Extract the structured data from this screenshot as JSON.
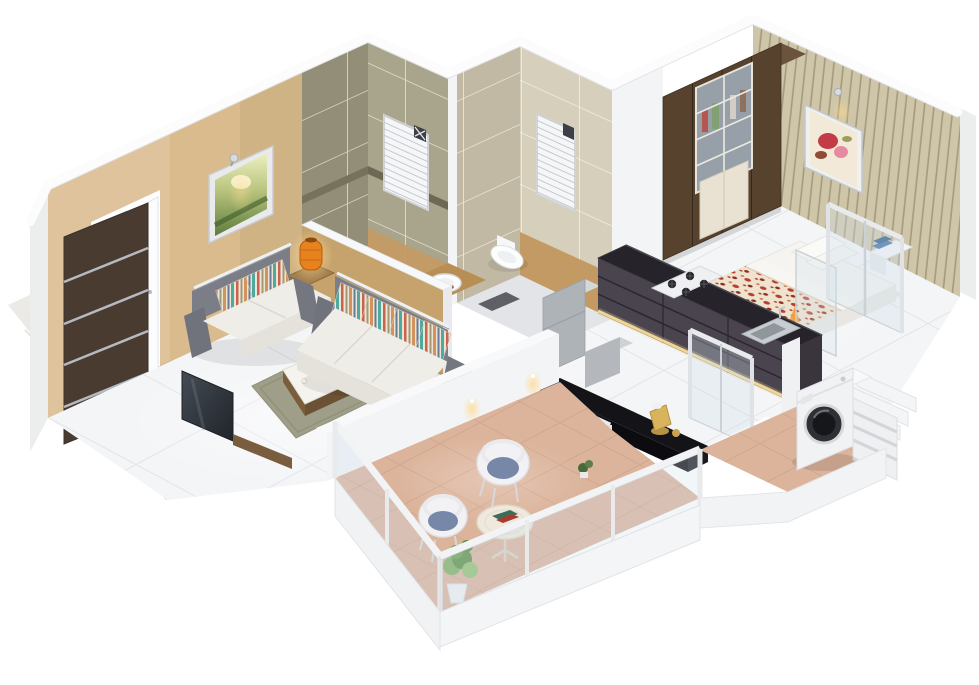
{
  "meta": {
    "aria_label": "3D isometric cutaway render of a 1 BHK apartment floor plan, dollhouse view from above, no text labels",
    "render_style": "isometric-cutaway-dollhouse",
    "visible_text": ""
  },
  "colors": {
    "background": "#ffffff",
    "floor_tile": "#f4f5f7",
    "wall_white": "#f3f4f6",
    "wall_side": "#eceded",
    "ceiling": "#fcfcfd",
    "wall_tan": "#d9bb8e",
    "half_wall_tan": "#c6a36d",
    "tile_olive": "#a9a58c",
    "tile_olive_dark": "#928e77",
    "tile_cream": "#d6cfbb",
    "tile_cream_dark": "#c1b9a3",
    "wood_accent": "#c49a64",
    "counter_wood": "#b98e55",
    "wallpaper": "#cfc5a8",
    "wardrobe_brown": "#57422d",
    "wardrobe_top": "#6b5340",
    "wardrobe_panel": "#e9e2d2",
    "door_brown": "#4a3b31",
    "tv_dark": "#343a42",
    "bed_white": "#f5f4f1",
    "duvet_base": "#efe3d0",
    "duvet_red": "#b5402e",
    "sofa_grey": "#7b7e86",
    "sofa_seat": "#efede8",
    "pillow_cream": "#ece6d8",
    "rug_olive": "#9a9a84",
    "lamp_orange": "#e8821f",
    "glow_warm": "#ffd98c",
    "kitchen_cabinet": "#4a444e",
    "counter_black": "#26242a",
    "island_black": "#141318",
    "stainless": "#c8cdd1",
    "steel": "#dfe2e6",
    "glass_tint": "#cfe0ea",
    "terracotta": "#dcb49c",
    "washer_white": "#f1f2f4",
    "washer_door": "#2e3036",
    "chair_white": "#f2f2f4",
    "cushion_blue": "#7787a8",
    "plant_green": "#7fae60",
    "marble": "#e9e7e4"
  },
  "scene": {
    "type": "3d-isometric-floor-plan-render",
    "unit": "1-bhk-apartment",
    "rooms": [
      {
        "id": "entrance",
        "items": [
          "marble-lobby-floor",
          "dark-brown-entrance-door",
          "steel-door-bars",
          "open-white-door"
        ]
      },
      {
        "id": "living-room",
        "items": [
          "tan-feature-wall",
          "framed-landscape-picture",
          "chrome-wall-spotlight",
          "two-seater-sofa",
          "three-seater-sofa",
          "striped-cushions",
          "chrome-sofa-rails",
          "side-table",
          "orange-table-lamp",
          "coffee-table",
          "olive-area-rug",
          "tv-panel",
          "glossy-white-tile-floor"
        ]
      },
      {
        "id": "bathroom-shower",
        "items": [
          "olive-green-wall-tiles",
          "louvered-window",
          "mosaic-border-band",
          "shower-tray",
          "vessel-washbasin",
          "wooden-basin-counter",
          "half-height-partition-wall",
          "dark-bath-mat"
        ]
      },
      {
        "id": "bathroom-wc",
        "items": [
          "cream-wall-tiles",
          "louvered-window",
          "wood-tone-dado",
          "wall-hung-toilet"
        ]
      },
      {
        "id": "bedroom",
        "items": [
          "pinstripe-wallpaper-wall",
          "framed-floral-picture",
          "wall-sconce",
          "wardrobe-with-glass-doors",
          "double-bed",
          "floral-red-duvet",
          "white-pillows",
          "bedside-table",
          "blue-books",
          "steel-glass-railing"
        ]
      },
      {
        "id": "kitchen",
        "items": [
          "charcoal-cabinet-run",
          "black-countertop",
          "four-burner-gas-hob",
          "stainless-sink",
          "under-cabinet-light-strip",
          "refrigerator",
          "kitchen-stool",
          "black-island-counter",
          "brass-kettle",
          "steel-glass-partitions"
        ]
      },
      {
        "id": "utility",
        "items": [
          "front-load-washing-machine",
          "terracotta-tile-floor",
          "louvered-panel",
          "stepped-ledges"
        ]
      },
      {
        "id": "balcony",
        "items": [
          "terracotta-tile-floor",
          "glass-parapet-railing",
          "white-railing-posts",
          "two-tub-chairs",
          "blue-seat-cushions",
          "round-side-table",
          "magazines",
          "potted-plant",
          "partition-downlights"
        ]
      }
    ]
  }
}
